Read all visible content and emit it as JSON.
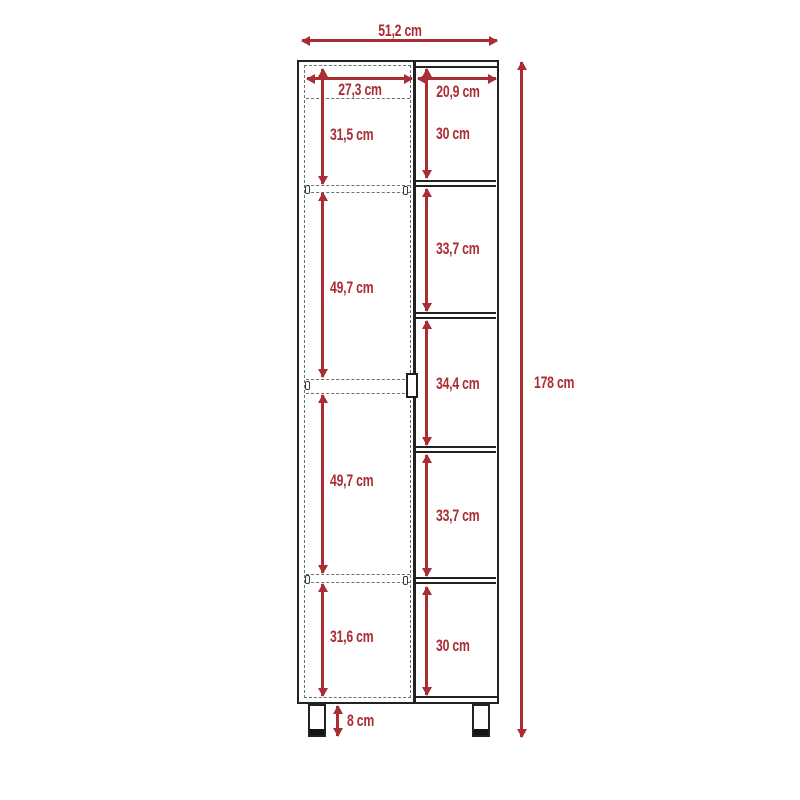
{
  "diagram": {
    "unit": "cm",
    "total_width": "51,2 cm",
    "total_height": "178 cm",
    "leg_height": "8 cm",
    "columns": {
      "left": {
        "width": "27,3 cm",
        "sections": [
          "31,5 cm",
          "49,7 cm",
          "49,7 cm",
          "31,6 cm"
        ]
      },
      "right": {
        "width": "20,9 cm",
        "sections": [
          "30 cm",
          "33,7 cm",
          "34,4 cm",
          "33,7 cm",
          "30 cm"
        ]
      }
    },
    "colors": {
      "dimension": "#a92d32",
      "outline": "#222222",
      "hidden_line": "#6e6e6e",
      "background": "#ffffff"
    }
  }
}
